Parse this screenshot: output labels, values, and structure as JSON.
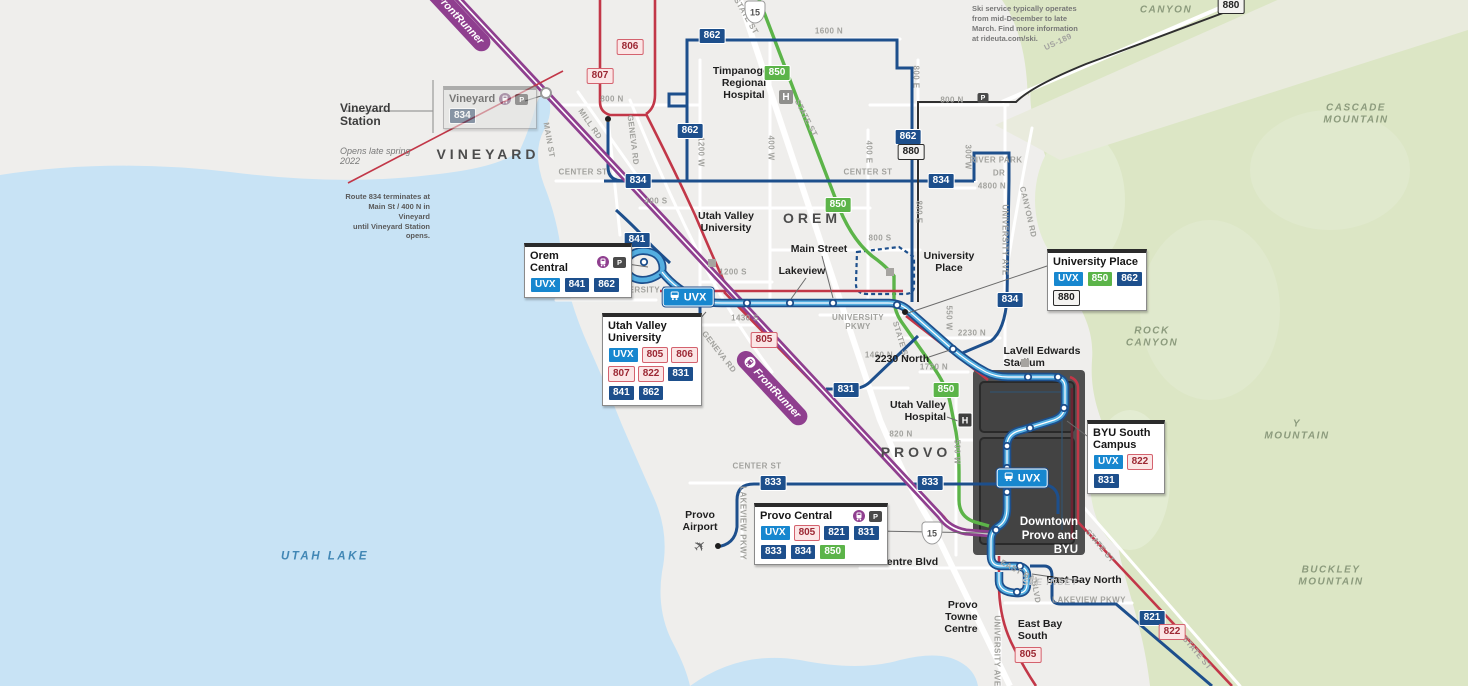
{
  "route_styles": {
    "805": "pink",
    "806": "pink",
    "807": "pink",
    "821": "navy",
    "822": "pink",
    "831": "navy",
    "833": "navy",
    "834": "navy",
    "841": "navy",
    "850": "green",
    "862": "navy",
    "880": "white",
    "UVX": "uvx"
  },
  "notes": {
    "vineyard": {
      "title": "Vineyard Station",
      "subtitle": "Opens late spring 2022",
      "body": "Route 834 terminates at\nMain St / 400 N in Vineyard\nuntil Vineyard Station opens."
    },
    "ski": {
      "text": "Ski service typically operates\nfrom mid-December to late\nMarch. Find more information\nat rideuta.com/ski."
    }
  },
  "inset": {
    "title": "Downtown\nProvo and\nBYU",
    "see": "SEE INSET"
  },
  "stations": {
    "vineyard": {
      "name": "Vineyard",
      "rows": [
        [
          "834"
        ]
      ]
    },
    "orem_central": {
      "name": "Orem Central",
      "rows": [
        [
          "UVX",
          "841",
          "862"
        ]
      ]
    },
    "uvu": {
      "name": "Utah Valley\nUniversity",
      "rows": [
        [
          "UVX",
          "805",
          "806"
        ],
        [
          "807",
          "822",
          "831"
        ],
        [
          "841",
          "862"
        ]
      ]
    },
    "university_place": {
      "name": "University Place",
      "rows": [
        [
          "UVX",
          "850",
          "862"
        ],
        [
          "880"
        ]
      ]
    },
    "byu_south": {
      "name": "BYU South\nCampus",
      "rows": [
        [
          "UVX",
          "822"
        ],
        [
          "831"
        ]
      ]
    },
    "provo_central": {
      "name": "Provo Central",
      "rows": [
        [
          "UVX",
          "805",
          "821",
          "831"
        ],
        [
          "833",
          "834",
          "850"
        ]
      ]
    }
  },
  "map": {
    "uvx_label": "UVX",
    "frontrunner_label": "FrontRunner",
    "uvx_pills": [
      {
        "x": 688,
        "y": 297
      },
      {
        "x": 1022,
        "y": 478
      }
    ],
    "fr_pills": [
      {
        "x": 455,
        "y": 14,
        "r": 47
      },
      {
        "x": 772,
        "y": 388,
        "r": 47
      }
    ],
    "badges": [
      {
        "t": "862",
        "x": 712,
        "y": 36
      },
      {
        "t": "806",
        "x": 630,
        "y": 47
      },
      {
        "t": "850",
        "x": 777,
        "y": 73
      },
      {
        "t": "807",
        "x": 600,
        "y": 76
      },
      {
        "t": "862",
        "x": 690,
        "y": 131
      },
      {
        "t": "862",
        "x": 908,
        "y": 137
      },
      {
        "t": "880",
        "x": 911,
        "y": 152
      },
      {
        "t": "880",
        "x": 1231,
        "y": 6
      },
      {
        "t": "834",
        "x": 638,
        "y": 181
      },
      {
        "t": "834",
        "x": 941,
        "y": 181
      },
      {
        "t": "850",
        "x": 838,
        "y": 205
      },
      {
        "t": "841",
        "x": 637,
        "y": 240
      },
      {
        "t": "834",
        "x": 1010,
        "y": 300
      },
      {
        "t": "805",
        "x": 764,
        "y": 340
      },
      {
        "t": "831",
        "x": 846,
        "y": 390
      },
      {
        "t": "850",
        "x": 946,
        "y": 390
      },
      {
        "t": "833",
        "x": 773,
        "y": 483
      },
      {
        "t": "833",
        "x": 930,
        "y": 483
      },
      {
        "t": "821",
        "x": 1152,
        "y": 618
      },
      {
        "t": "822",
        "x": 1172,
        "y": 632
      },
      {
        "t": "805",
        "x": 1028,
        "y": 655
      }
    ],
    "labels": [
      {
        "t": "VINEYARD",
        "c": "city",
        "x": 488,
        "y": 154,
        "n": "city-label-vineyard"
      },
      {
        "t": "OREM",
        "c": "city",
        "x": 812,
        "y": 218,
        "n": "city-label-orem"
      },
      {
        "t": "PROVO",
        "c": "city",
        "x": 916,
        "y": 452,
        "n": "city-label-provo"
      },
      {
        "t": "UTAH LAKE",
        "c": "lake",
        "x": 325,
        "y": 557,
        "n": "geo-label-utah-lake"
      },
      {
        "t": "CANYON",
        "c": "mtn",
        "x": 1166,
        "y": 10,
        "n": "geo-label-canyon"
      },
      {
        "t": "CASCADE\nMOUNTAIN",
        "c": "mtn",
        "x": 1356,
        "y": 114,
        "n": "geo-label-cascade-mountain"
      },
      {
        "t": "ROCK\nCANYON",
        "c": "mtn",
        "x": 1152,
        "y": 337,
        "n": "geo-label-rock-canyon"
      },
      {
        "t": "Y\nMOUNTAIN",
        "c": "mtn",
        "x": 1297,
        "y": 430,
        "n": "geo-label-y-mountain"
      },
      {
        "t": "BUCKLEY\nMOUNTAIN",
        "c": "mtn",
        "x": 1331,
        "y": 576,
        "n": "geo-label-buckley-mountain"
      },
      {
        "t": "US-189",
        "c": "st",
        "x": 1058,
        "y": 42,
        "r": -25
      },
      {
        "t": "1600 N",
        "c": "st",
        "x": 829,
        "y": 31
      },
      {
        "t": "800 N",
        "c": "st",
        "x": 612,
        "y": 99
      },
      {
        "t": "800 N",
        "c": "st",
        "x": 952,
        "y": 100
      },
      {
        "t": "CENTER ST",
        "c": "st",
        "x": 583,
        "y": 172
      },
      {
        "t": "CENTER ST",
        "c": "st",
        "x": 868,
        "y": 172
      },
      {
        "t": "CENTER ST",
        "c": "st",
        "x": 757,
        "y": 466
      },
      {
        "t": "400 S",
        "c": "st",
        "x": 656,
        "y": 201
      },
      {
        "t": "800 S",
        "c": "st",
        "x": 880,
        "y": 238
      },
      {
        "t": "1200 S",
        "c": "st",
        "x": 733,
        "y": 272
      },
      {
        "t": "1430 S",
        "c": "st",
        "x": 745,
        "y": 318
      },
      {
        "t": "1460 N",
        "c": "st",
        "x": 879,
        "y": 355
      },
      {
        "t": "1720 N",
        "c": "st",
        "x": 934,
        "y": 367
      },
      {
        "t": "2230 N",
        "c": "st",
        "x": 972,
        "y": 333
      },
      {
        "t": "4800 N",
        "c": "st",
        "x": 992,
        "y": 186
      },
      {
        "t": "820 N",
        "c": "st",
        "x": 901,
        "y": 434
      },
      {
        "t": "RIVER PARK",
        "c": "st",
        "x": 996,
        "y": 160
      },
      {
        "t": "DR",
        "c": "st",
        "x": 999,
        "y": 173
      },
      {
        "t": "UNIVERSITY PKWY",
        "c": "st",
        "x": 648,
        "y": 290
      },
      {
        "t": "UNIVERSITY\nPKWY",
        "c": "st",
        "x": 858,
        "y": 322
      },
      {
        "t": "MAIN ST",
        "c": "st",
        "x": 549,
        "y": 140,
        "r": 80
      },
      {
        "t": "MILL RD",
        "c": "st",
        "x": 590,
        "y": 124,
        "r": 55
      },
      {
        "t": "GENEVA RD",
        "c": "st",
        "x": 633,
        "y": 140,
        "r": 83
      },
      {
        "t": "GENEVA RD",
        "c": "st",
        "x": 719,
        "y": 352,
        "r": 52
      },
      {
        "t": "1200 W",
        "c": "st",
        "x": 701,
        "y": 152,
        "r": 90
      },
      {
        "t": "400 W",
        "c": "st",
        "x": 771,
        "y": 148,
        "r": 90
      },
      {
        "t": "400 E",
        "c": "st",
        "x": 869,
        "y": 152,
        "r": 90
      },
      {
        "t": "800 E",
        "c": "st",
        "x": 916,
        "y": 77,
        "r": 90
      },
      {
        "t": "800 E",
        "c": "st",
        "x": 919,
        "y": 212,
        "r": 90
      },
      {
        "t": "300 W",
        "c": "st",
        "x": 968,
        "y": 157,
        "r": 90
      },
      {
        "t": "CANYON RD",
        "c": "st",
        "x": 1028,
        "y": 212,
        "r": 77
      },
      {
        "t": "UNIVERSITY AVE",
        "c": "st",
        "x": 1005,
        "y": 240,
        "r": 90
      },
      {
        "t": "550 W",
        "c": "st",
        "x": 949,
        "y": 318,
        "r": 90
      },
      {
        "t": "500 W",
        "c": "st",
        "x": 957,
        "y": 452,
        "r": 90
      },
      {
        "t": "STATE ST",
        "c": "st",
        "x": 746,
        "y": 16,
        "r": 60
      },
      {
        "t": "STATE ST",
        "c": "st",
        "x": 806,
        "y": 118,
        "r": 63
      },
      {
        "t": "STATE ST",
        "c": "st",
        "x": 901,
        "y": 341,
        "r": 73
      },
      {
        "t": "STATE ST",
        "c": "st",
        "x": 1100,
        "y": 546,
        "r": 50
      },
      {
        "t": "STATE ST",
        "c": "st",
        "x": 1197,
        "y": 653,
        "r": 50
      },
      {
        "t": "LAKEVIEW PKWY",
        "c": "st",
        "x": 743,
        "y": 523,
        "r": 90
      },
      {
        "t": "LAKEVIEW PKWY",
        "c": "st",
        "x": 1089,
        "y": 600
      },
      {
        "t": "EAST BAY",
        "c": "st",
        "x": 1020,
        "y": 572,
        "r": 28
      },
      {
        "t": "BLVD",
        "c": "st",
        "x": 1036,
        "y": 592,
        "r": 80
      },
      {
        "t": "UNIVERSITY AVE",
        "c": "st",
        "x": 997,
        "y": 651,
        "r": 90
      },
      {
        "t": "Timpanogos\nRegional\nHospital",
        "c": "stop",
        "x": 744,
        "y": 83,
        "al": "center",
        "n": "poi-label-timpanogos-hospital"
      },
      {
        "t": "Main Street",
        "c": "stop",
        "x": 819,
        "y": 249,
        "n": "stop-label-main-street"
      },
      {
        "t": "Lakeview",
        "c": "stop",
        "x": 802,
        "y": 271,
        "n": "stop-label-lakeview"
      },
      {
        "t": "Utah Valley\nUniversity",
        "c": "stop",
        "x": 726,
        "y": 222,
        "al": "center",
        "n": "poi-label-uvu"
      },
      {
        "t": "University\nPlace",
        "c": "stop",
        "x": 949,
        "y": 262,
        "al": "center",
        "n": "poi-label-university-place"
      },
      {
        "t": "2230 North",
        "c": "stop",
        "x": 902,
        "y": 359,
        "n": "stop-label-2230-north"
      },
      {
        "t": "LaVell Edwards\nStadium",
        "c": "stop",
        "x": 1042,
        "y": 357,
        "al": "left",
        "n": "poi-label-lavell-edwards-stadium"
      },
      {
        "t": "Utah Valley\nHospital",
        "c": "stop",
        "x": 918,
        "y": 411,
        "al": "right",
        "n": "poi-label-utah-valley-hospital"
      },
      {
        "t": "Provo\nAirport",
        "c": "stop",
        "x": 700,
        "y": 521,
        "al": "center",
        "n": "poi-label-provo-airport"
      },
      {
        "t": "Towne Centre Blvd",
        "c": "stop",
        "x": 891,
        "y": 562,
        "n": "stop-label-towne-centre-blvd"
      },
      {
        "t": "East Bay North",
        "c": "stop",
        "x": 1084,
        "y": 580,
        "n": "stop-label-east-bay-north"
      },
      {
        "t": "East Bay\nSouth",
        "c": "stop",
        "x": 1040,
        "y": 630,
        "al": "left",
        "n": "stop-label-east-bay-south"
      },
      {
        "t": "Provo\nTowne\nCentre",
        "c": "stop",
        "x": 961,
        "y": 617,
        "al": "right",
        "n": "poi-label-provo-towne-centre"
      }
    ],
    "markers": [
      {
        "k": "h-gray",
        "t": "H",
        "x": 786,
        "y": 97,
        "n": "hospital-icon-timpanogos"
      },
      {
        "k": "h-dark",
        "t": "H",
        "x": 965,
        "y": 420,
        "n": "hospital-icon-utah-valley"
      },
      {
        "k": "sq",
        "x": 712,
        "y": 263,
        "n": "poi-square-uvu"
      },
      {
        "k": "sq",
        "x": 890,
        "y": 272,
        "n": "poi-square-university-place"
      },
      {
        "k": "sq",
        "x": 1025,
        "y": 363,
        "n": "poi-square-stadium"
      },
      {
        "k": "pr",
        "t": "P",
        "x": 983,
        "y": 98,
        "n": "park-and-ride-icon"
      },
      {
        "k": "circ",
        "x": 546,
        "y": 93,
        "n": "future-station-circle"
      },
      {
        "k": "bdot",
        "x": 905,
        "y": 312,
        "n": "stop-dot"
      },
      {
        "k": "bdot",
        "x": 608,
        "y": 119,
        "n": "terminus-dot"
      },
      {
        "k": "bdot",
        "x": 718,
        "y": 546,
        "n": "airport-stop-dot"
      },
      {
        "k": "plane",
        "t": "✈",
        "x": 700,
        "y": 546,
        "n": "airplane-icon"
      },
      {
        "k": "shield",
        "t": "15",
        "x": 755,
        "y": 12,
        "n": "interstate-15-shield"
      },
      {
        "k": "shield",
        "t": "15",
        "x": 932,
        "y": 533,
        "n": "interstate-15-shield"
      }
    ]
  }
}
